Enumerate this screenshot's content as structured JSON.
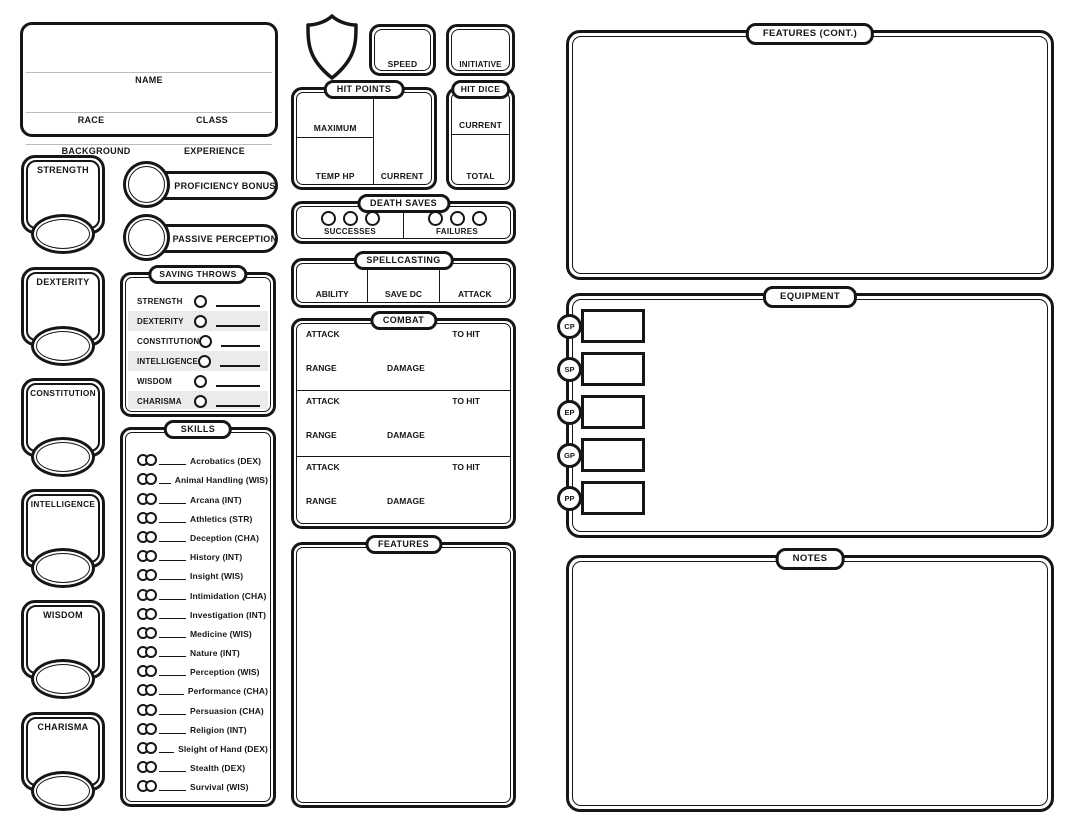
{
  "colors": {
    "ink": "#161616",
    "paper": "#ffffff",
    "shaded_row": "#ebebeb",
    "light_line": "#bcbcbc"
  },
  "header": {
    "name_label": "NAME",
    "race_label": "RACE",
    "class_label": "CLASS",
    "background_label": "BACKGROUND",
    "experience_label": "EXPERIENCE"
  },
  "top_stats": {
    "shield_icon": "shield-icon",
    "speed_label": "SPEED",
    "initiative_label": "INITIATIVE"
  },
  "hit_points": {
    "title": "HIT POINTS",
    "maximum_label": "MAXIMUM",
    "temp_hp_label": "TEMP HP",
    "current_label": "CURRENT"
  },
  "hit_dice": {
    "title": "HIT DICE",
    "current_label": "CURRENT",
    "total_label": "TOTAL"
  },
  "death_saves": {
    "title": "DEATH SAVES",
    "successes_label": "SUCCESSES",
    "failures_label": "FAILURES",
    "circles_per_side": 3
  },
  "spellcasting": {
    "title": "SPELLCASTING",
    "columns": [
      "ABILITY",
      "SAVE DC",
      "ATTACK"
    ]
  },
  "combat": {
    "title": "COMBAT",
    "attack_label": "ATTACK",
    "to_hit_label": "TO HIT",
    "range_label": "RANGE",
    "damage_label": "DAMAGE",
    "entry_count": 3
  },
  "features": {
    "title": "FEATURES"
  },
  "proficiency": {
    "bonus_label": "PROFICIENCY BONUS",
    "passive_label": "PASSIVE PERCEPTION"
  },
  "abilities": {
    "items": [
      {
        "label": "STRENGTH"
      },
      {
        "label": "DEXTERITY"
      },
      {
        "label": "CONSTITUTION"
      },
      {
        "label": "INTELLIGENCE"
      },
      {
        "label": "WISDOM"
      },
      {
        "label": "CHARISMA"
      }
    ]
  },
  "saving_throws": {
    "title": "SAVING THROWS",
    "items": [
      "STRENGTH",
      "DEXTERITY",
      "CONSTITUTION",
      "INTELLIGENCE",
      "WISDOM",
      "CHARISMA"
    ]
  },
  "skills": {
    "title": "SKILLS",
    "items": [
      "Acrobatics (DEX)",
      "Animal Handling (WIS)",
      "Arcana (INT)",
      "Athletics (STR)",
      "Deception (CHA)",
      "History (INT)",
      "Insight (WIS)",
      "Intimidation (CHA)",
      "Investigation (INT)",
      "Medicine (WIS)",
      "Nature (INT)",
      "Perception (WIS)",
      "Performance (CHA)",
      "Persuasion (CHA)",
      "Religion (INT)",
      "Sleight of Hand (DEX)",
      "Stealth (DEX)",
      "Survival (WIS)"
    ]
  },
  "right_column": {
    "features_cont": {
      "title": "FEATURES (CONT.)"
    },
    "equipment": {
      "title": "EQUIPMENT",
      "currencies": [
        "CP",
        "SP",
        "EP",
        "GP",
        "PP"
      ]
    },
    "notes": {
      "title": "NOTES"
    }
  }
}
